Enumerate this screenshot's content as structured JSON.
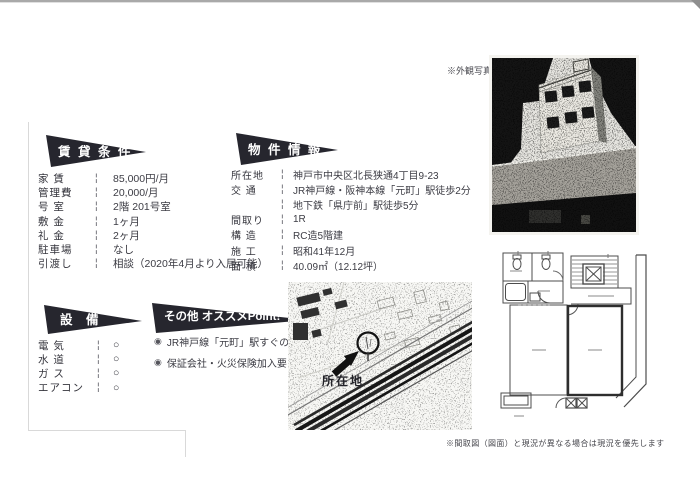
{
  "colors": {
    "banner": "#26262e",
    "text": "#3c3c44",
    "ink": "#1a1a1a"
  },
  "misc": {
    "separator": "¦"
  },
  "rental": {
    "title": "賃 貸 条 件",
    "rows": [
      {
        "label": "家 賃",
        "value": "85,000円/月"
      },
      {
        "label": "管理費",
        "value": "20,000/月"
      },
      {
        "label": "号 室",
        "value": "2階  201号室"
      },
      {
        "label": "敷 金",
        "value": "1ヶ月"
      },
      {
        "label": "礼 金",
        "value": "2ヶ月"
      },
      {
        "label": "駐車場",
        "value": "なし"
      },
      {
        "label": "引渡し",
        "value": "相談（2020年4月より入居可能）"
      }
    ]
  },
  "property": {
    "title": "物 件 情 報",
    "rows": [
      {
        "label": "所在地",
        "value": "神戸市中央区北長狭通4丁目9-23"
      },
      {
        "label": "交 通",
        "value": "JR神戸線・阪神本線「元町」駅徒歩2分",
        "value2": "地下鉄「県庁前」駅徒歩5分"
      },
      {
        "label": "間取り",
        "value": "1R"
      },
      {
        "label": "構 造",
        "value": "RC造5階建"
      },
      {
        "label": "施 工",
        "value": "昭和41年12月"
      },
      {
        "label": "面 積",
        "value": "40.09㎡（12.12坪）"
      }
    ]
  },
  "equipment": {
    "title": "設 備",
    "rows": [
      {
        "label": "電 気",
        "value": "○"
      },
      {
        "label": "水 道",
        "value": "○"
      },
      {
        "label": "ガ ス",
        "value": "○"
      },
      {
        "label": "エアコン",
        "value": "○"
      }
    ]
  },
  "points": {
    "title": "その他 オススメPoint!",
    "bullet": "◉",
    "items": [
      "JR神戸線「元町」駅すぐの好立地",
      "保証会社・火災保険加入要"
    ]
  },
  "map": {
    "marker_label": "所在地"
  },
  "photo": {
    "caption": "※外観写真"
  },
  "floorplan": {
    "caption": "※間取図（図面）と現況が異なる場合は現況を優先します"
  }
}
